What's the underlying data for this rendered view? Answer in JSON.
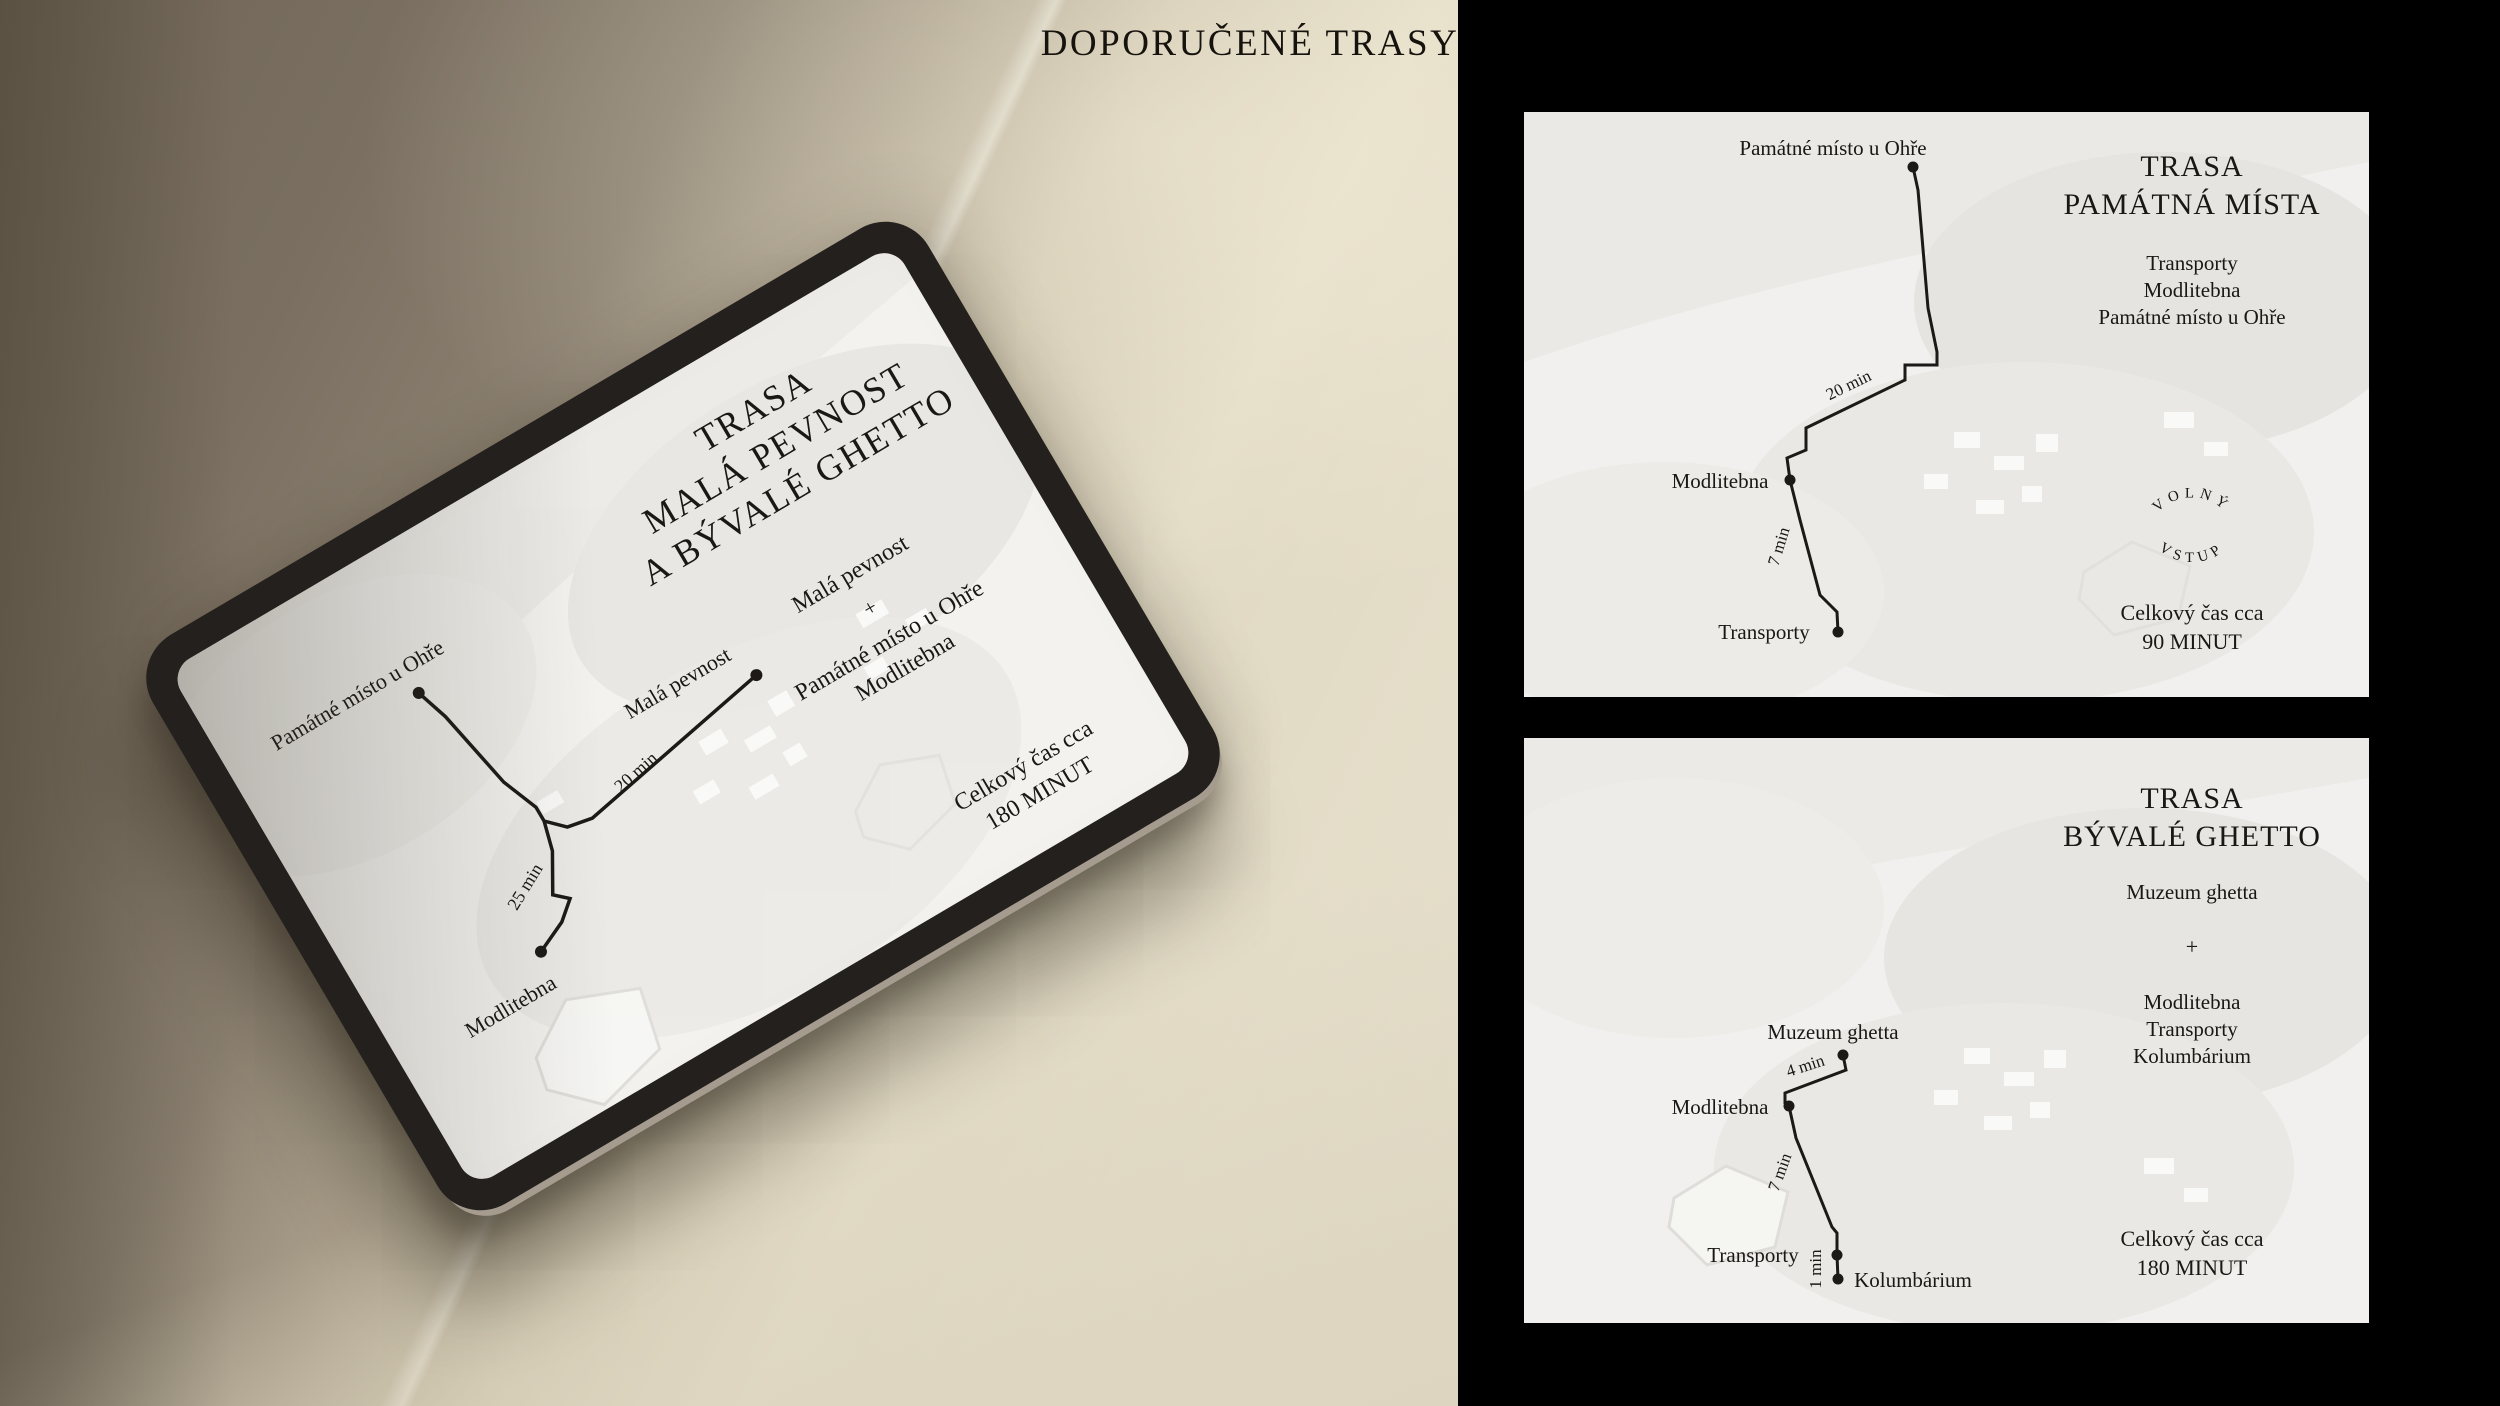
{
  "page": {
    "title": "DOPORUČENÉ TRASY"
  },
  "colors": {
    "ink": "#1a1714",
    "panel_bg": "#000000",
    "card_bg": "#f1f0ee",
    "screen_bg": "#f3f2ef",
    "bezel": "#23201d",
    "stone_dark": "#7a6f60",
    "stone_light": "#e2dbc5"
  },
  "tablet": {
    "title_lines": [
      "TRASA",
      "MALÁ PEVNOST",
      "A BÝVALÉ GHETTO"
    ],
    "stop_featured": "Malá pevnost",
    "plus": "+",
    "stop_list": [
      "Památné místo u Ohře",
      "Modlitebna"
    ],
    "total_label": "Celkový čas cca",
    "total_value": "180 MINUT",
    "route": {
      "stops": {
        "pamatne": "Památné místo u Ohře",
        "mala": "Malá pevnost",
        "modlitebna": "Modlitebna"
      },
      "durations": {
        "d20": "20 min",
        "d25": "25 min"
      }
    }
  },
  "card1": {
    "title_lines": [
      "TRASA",
      "PAMÁTNÁ MÍSTA"
    ],
    "stop_list": [
      "Transporty",
      "Modlitebna",
      "Památné místo u Ohře"
    ],
    "badge": {
      "top": "VOLNÝ",
      "bottom": "VSTUP"
    },
    "total_label": "Celkový čas cca",
    "total_value": "90 MINUT",
    "route": {
      "stops": {
        "pamatne": "Památné místo u Ohře",
        "modlitebna": "Modlitebna",
        "transporty": "Transporty"
      },
      "durations": {
        "d1": "20 min",
        "d2": "7 min"
      }
    }
  },
  "card2": {
    "title_lines": [
      "TRASA",
      "BÝVALÉ GHETTO"
    ],
    "stop_featured": "Muzeum ghetta",
    "plus": "+",
    "stop_list": [
      "Modlitebna",
      "Transporty",
      "Kolumbárium"
    ],
    "total_label": "Celkový čas cca",
    "total_value": "180 MINUT",
    "route": {
      "stops": {
        "muzeum": "Muzeum ghetta",
        "modlitebna": "Modlitebna",
        "transporty": "Transporty",
        "kolumbarium": "Kolumbárium"
      },
      "durations": {
        "d1": "4 min",
        "d2": "7 min",
        "d3": "1 min"
      }
    }
  }
}
